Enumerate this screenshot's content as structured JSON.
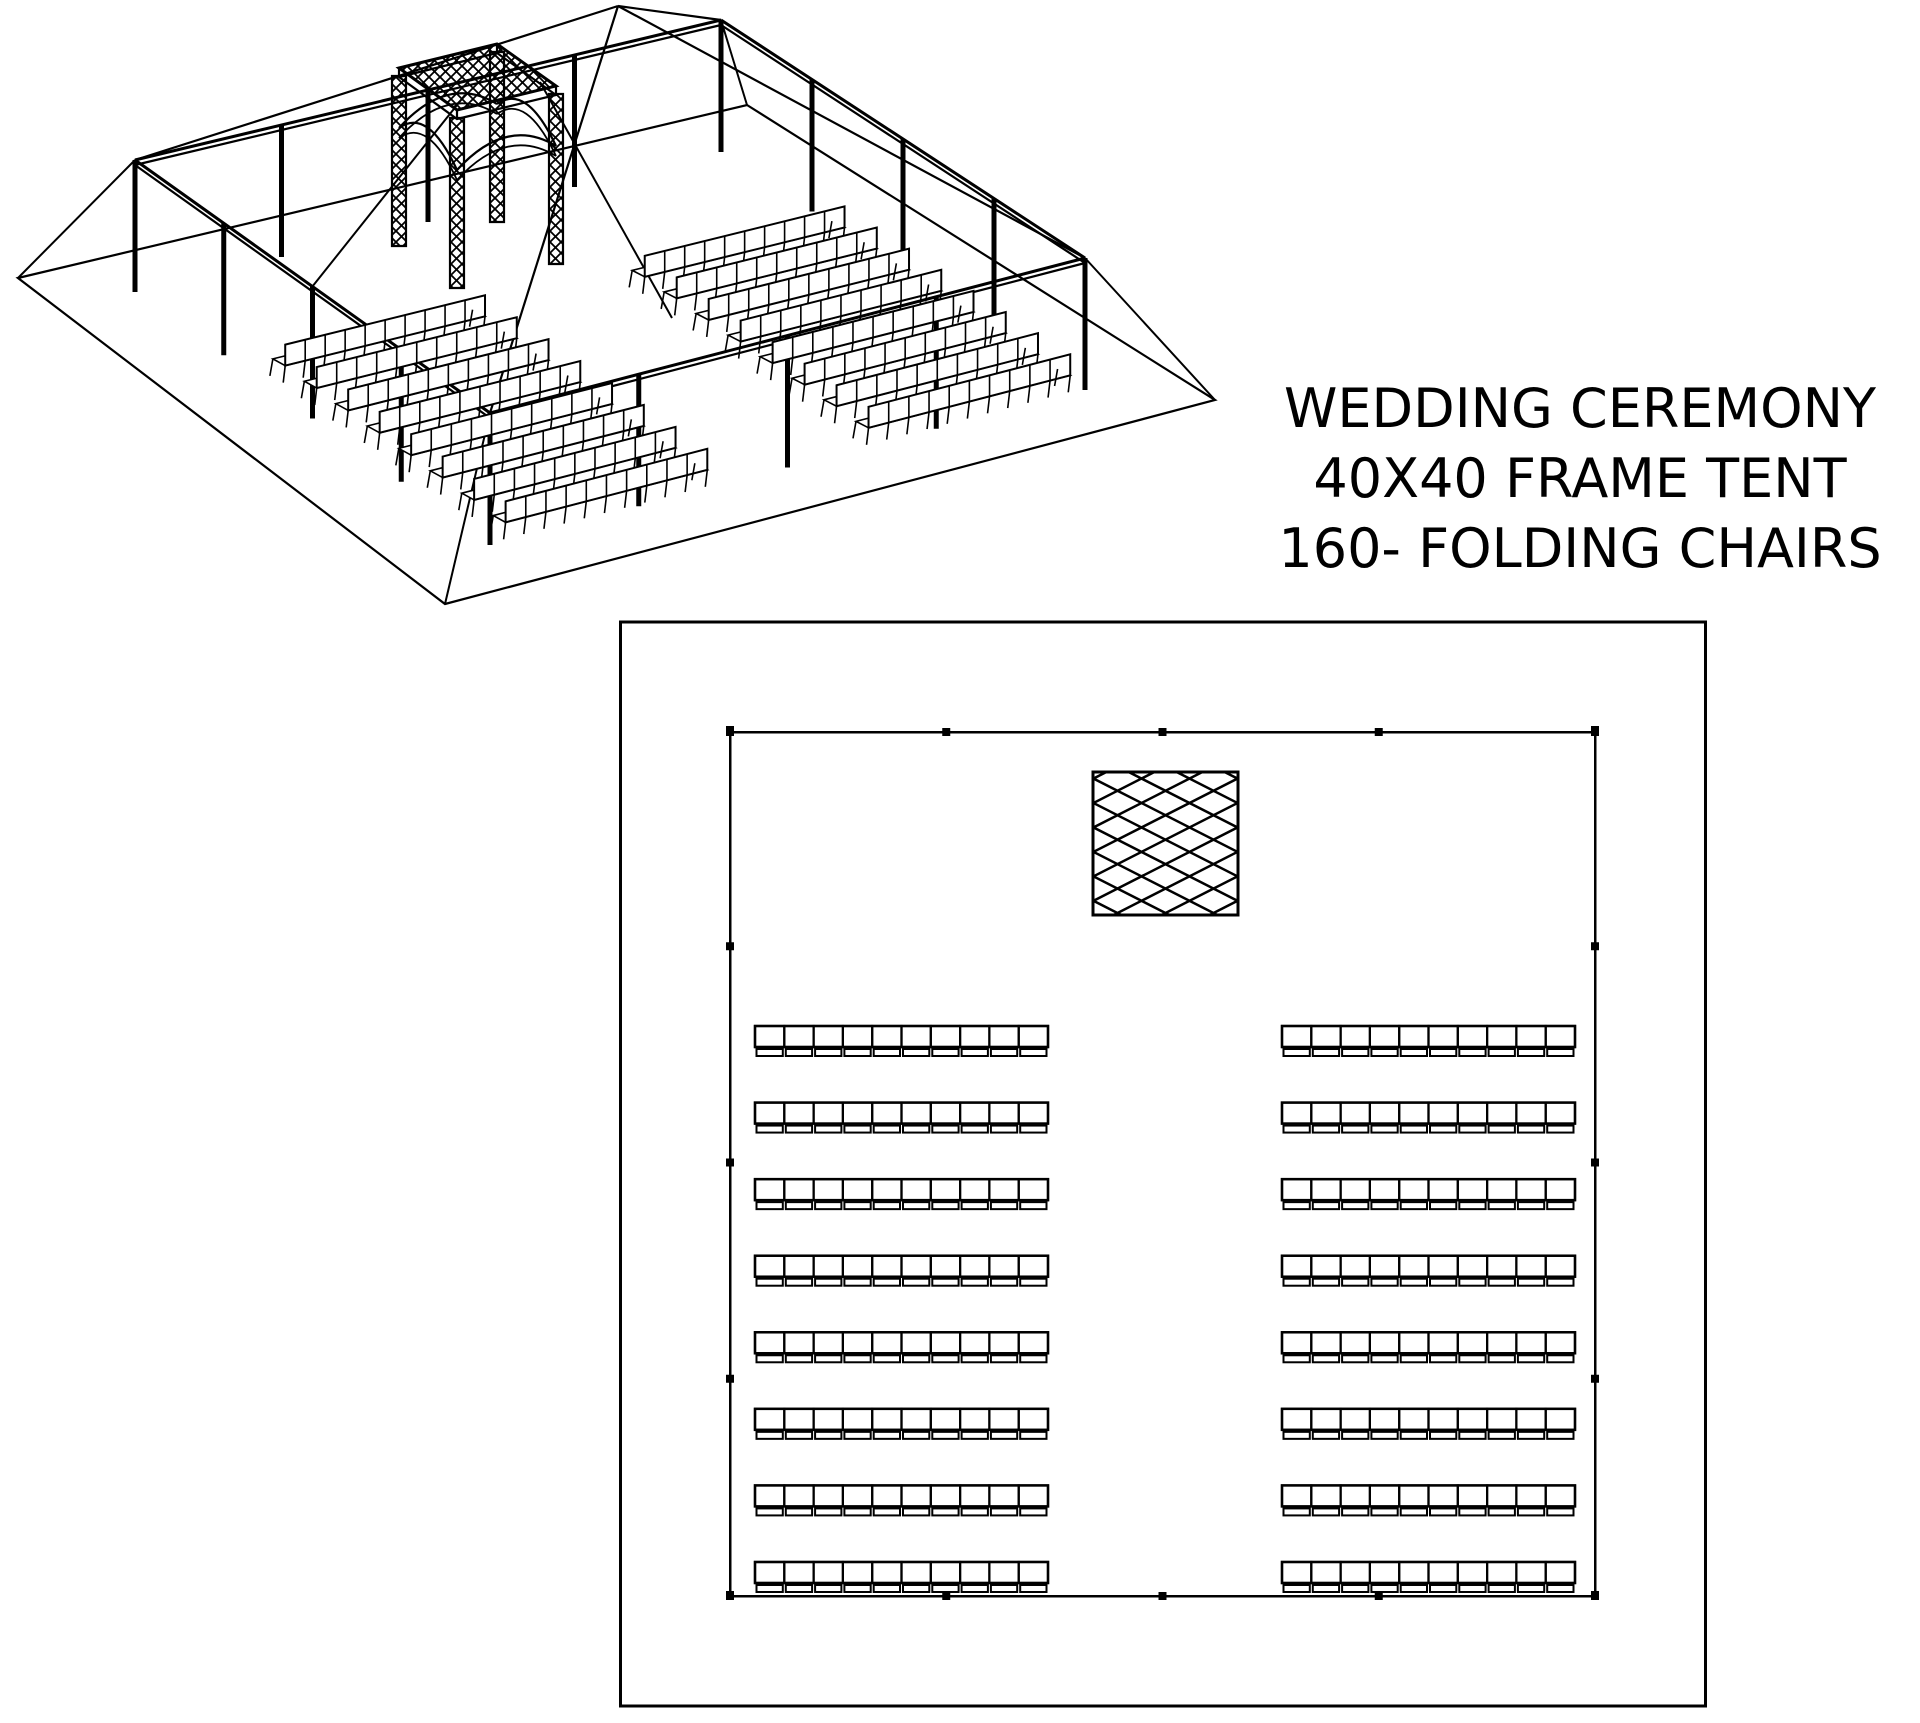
{
  "page": {
    "background": "#ffffff",
    "line_color": "#000000"
  },
  "title_block": {
    "line1": "WEDDING CEREMONY",
    "line2": "40X40 FRAME TENT",
    "line3": "160- FOLDING CHAIRS"
  },
  "diagram": {
    "type": "tent-event-layout-drawing",
    "views": [
      {
        "name": "isometric view",
        "position": "top-left"
      },
      {
        "name": "floor plan",
        "position": "bottom-center"
      }
    ],
    "tent": {
      "width_ft": 40,
      "length_ft": 40,
      "style": "frame tent",
      "legs_per_side": 5,
      "leg_spacing_ft": 10
    },
    "seating": {
      "total_chairs": 160,
      "chair_type": "folding chairs",
      "blocks": 2,
      "rows_per_block": 8,
      "chairs_per_row": 10,
      "aisle": "center"
    },
    "features": [
      {
        "name": "wedding arch trellis",
        "plan_marker": "crosshatched square",
        "location": "top center inside tent"
      }
    ]
  }
}
